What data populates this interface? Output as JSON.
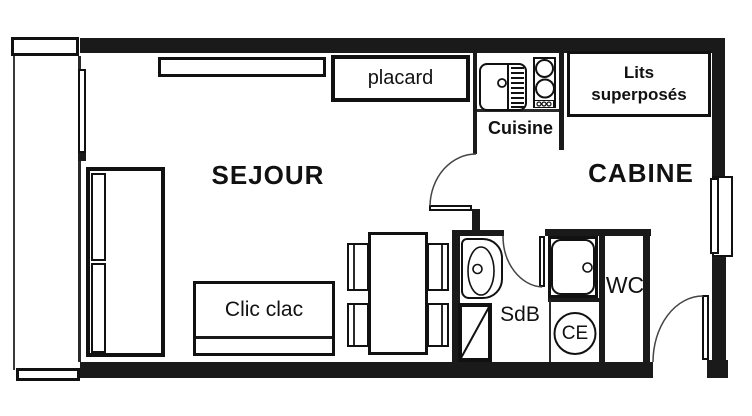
{
  "labels": {
    "sejour": "SEJOUR",
    "cabine": "CABINE",
    "cuisine": "Cuisine",
    "placard": "placard",
    "lits_superposes": "Lits superposés",
    "clic_clac": "Clic clac",
    "sdb": "SdB",
    "wc": "WC",
    "ce": "CE"
  },
  "colors": {
    "wall": "#1a1a1a",
    "line": "#111111",
    "door_arc": "#444444",
    "background": "#ffffff"
  }
}
